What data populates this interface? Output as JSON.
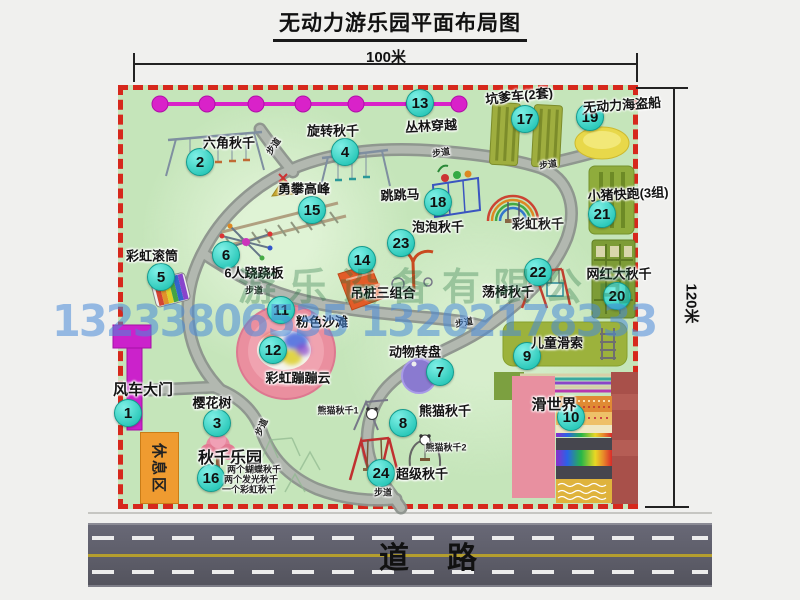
{
  "title": "无动力游乐园平面布局图",
  "dims": {
    "top": "100米",
    "right": "120米"
  },
  "road_label": "道　路",
  "rest_area_label": "休息区",
  "watermarks": {
    "company": "游乐设备有限公司",
    "phones": "13233806535 13202178333"
  },
  "colors": {
    "park_green": "#c5e5ba",
    "border_red": "#d6281c",
    "marker_teal": "#2cc9ba",
    "gate_magenta": "#cb22cb",
    "road_gray": "#55555f",
    "rest_orange": "#ef9b30",
    "watermark_blue": "#488ad8",
    "watermark_green": "#1e703e"
  },
  "map": {
    "attractions": [
      {
        "num": "1",
        "name": "风车大门",
        "circle": [
          128,
          413
        ],
        "label": [
          143,
          389
        ],
        "size": 15
      },
      {
        "num": "2",
        "name": "六角秋千",
        "circle": [
          200,
          162
        ],
        "label": [
          229,
          142
        ]
      },
      {
        "num": "3",
        "name": "樱花树",
        "circle": [
          217,
          423
        ],
        "label": [
          212,
          402
        ]
      },
      {
        "num": "4",
        "name": "旋转秋千",
        "circle": [
          345,
          152
        ],
        "label": [
          333,
          130
        ]
      },
      {
        "num": "5",
        "name": "彩虹滚筒",
        "circle": [
          161,
          277
        ],
        "label": [
          152,
          255
        ]
      },
      {
        "num": "6",
        "name": "6人跷跷板",
        "circle": [
          226,
          255
        ],
        "label": [
          254,
          272
        ]
      },
      {
        "num": "7",
        "name": "动物转盘",
        "circle": [
          440,
          372
        ],
        "label": [
          415,
          351
        ]
      },
      {
        "num": "8",
        "name": "熊猫秋千",
        "circle": [
          403,
          423
        ],
        "label": [
          445,
          410
        ]
      },
      {
        "num": "9",
        "name": "儿童滑索",
        "circle": [
          527,
          356
        ],
        "label": [
          557,
          342
        ]
      },
      {
        "num": "10",
        "name": "滑世界",
        "circle": [
          571,
          417
        ],
        "label": [
          554,
          404
        ],
        "size": 15
      },
      {
        "num": "11",
        "name": "粉色沙滩",
        "circle": [
          281,
          310
        ],
        "label": [
          322,
          321
        ]
      },
      {
        "num": "12",
        "name": "彩虹蹦蹦云",
        "circle": [
          273,
          350
        ],
        "label": [
          298,
          377
        ]
      },
      {
        "num": "13",
        "name": "丛林穿越",
        "circle": [
          420,
          103
        ],
        "label": [
          431,
          125
        ],
        "rot": -3
      },
      {
        "num": "14",
        "name": "吊桩三组合",
        "circle": [
          362,
          260
        ],
        "label": [
          383,
          292
        ]
      },
      {
        "num": "15",
        "name": "勇攀高峰",
        "circle": [
          312,
          210
        ],
        "label": [
          304,
          188
        ]
      },
      {
        "num": "16",
        "name": "秋千乐园",
        "circle": [
          211,
          478
        ],
        "label": [
          230,
          456
        ],
        "size": 16
      },
      {
        "num": "17",
        "name": "坑爹车(2套)",
        "circle": [
          525,
          119
        ],
        "label": [
          519,
          95
        ],
        "rot": -6
      },
      {
        "num": "18",
        "name": "跳跳马",
        "circle": [
          438,
          202
        ],
        "label": [
          400,
          194
        ],
        "rot": -3
      },
      {
        "num": "19",
        "name": "无动力海盗船",
        "circle": [
          590,
          117
        ],
        "label": [
          622,
          104
        ],
        "rot": -4
      },
      {
        "num": "20",
        "name": "网红大秋千",
        "circle": [
          617,
          296
        ],
        "label": [
          619,
          273
        ]
      },
      {
        "num": "21",
        "name": "小猪快跑(3组)",
        "circle": [
          602,
          214
        ],
        "label": [
          628,
          193
        ],
        "rot": -3
      },
      {
        "num": "22",
        "name": "荡椅秋千",
        "circle": [
          538,
          272
        ],
        "label": [
          508,
          291
        ]
      },
      {
        "num": "23",
        "name": "泡泡秋千",
        "circle": [
          401,
          243
        ],
        "label": [
          438,
          226
        ]
      },
      {
        "num": "24",
        "name": "超级秋千",
        "circle": [
          381,
          473
        ],
        "label": [
          422,
          473
        ]
      }
    ],
    "notes": [
      {
        "text": "彩虹秋千",
        "pos": [
          538,
          223
        ],
        "size": 13,
        "bold": true
      },
      {
        "text": "熊猫秋千1",
        "pos": [
          338,
          410
        ]
      },
      {
        "text": "熊猫秋千2",
        "pos": [
          446,
          447
        ]
      },
      {
        "text": "两个蝴蝶秋千",
        "pos": [
          254,
          469
        ]
      },
      {
        "text": "两个发光秋千",
        "pos": [
          251,
          479
        ]
      },
      {
        "text": "一个彩虹秋千",
        "pos": [
          249,
          489
        ]
      },
      {
        "text": "步道",
        "pos": [
          273,
          146
        ],
        "rot": -55
      },
      {
        "text": "步道",
        "pos": [
          441,
          152
        ],
        "rot": -8
      },
      {
        "text": "步道",
        "pos": [
          548,
          164
        ],
        "rot": -8
      },
      {
        "text": "步道",
        "pos": [
          254,
          290
        ]
      },
      {
        "text": "步道",
        "pos": [
          464,
          322
        ],
        "rot": -10
      },
      {
        "text": "步道",
        "pos": [
          261,
          427
        ],
        "rot": -65
      },
      {
        "text": "步道",
        "pos": [
          383,
          492
        ]
      }
    ]
  }
}
